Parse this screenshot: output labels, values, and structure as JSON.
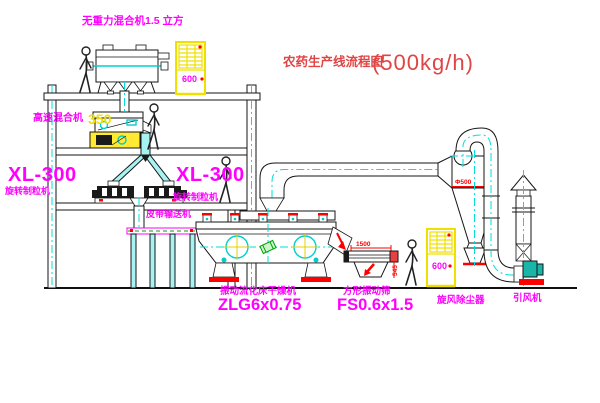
{
  "title": {
    "text": "农药生产线流程图",
    "capacity": "(500kg/h)"
  },
  "labels": {
    "gravity_mixer": "无重力混合机1.5 立方",
    "high_speed_mixer": "高速混合机",
    "high_speed_mixer_model": "350",
    "granulator_left_model": "XL-300",
    "granulator_left_name": "旋转制粒机",
    "granulator_right_model": "XL-300",
    "granulator_right_name": "旋转制粒机",
    "belt_conveyor": "皮带输送机",
    "dryer_name": "振动流化床干燥机",
    "dryer_model": "ZLG6x0.75",
    "sieve_name": "方形振动筛",
    "sieve_model": "FS0.6x1.5",
    "cyclone_name": "旋风除尘器",
    "fan_name": "引风机"
  },
  "dimensions": {
    "sieve_length": "1500",
    "sieve_height": "545",
    "cyclone_diameter": "Φ500"
  },
  "cabinet_marks": {
    "cabinet_top": "600",
    "cabinet_ground": "600"
  },
  "colors": {
    "label_magenta": "#FF00FF",
    "title_red": "#E04545",
    "centerline_cyan": "#00DEDE",
    "cad_yellow": "#F0E000",
    "dimension_red": "#FF0000",
    "fan_teal": "#18B5A8",
    "hatch_green": "#00A000"
  }
}
